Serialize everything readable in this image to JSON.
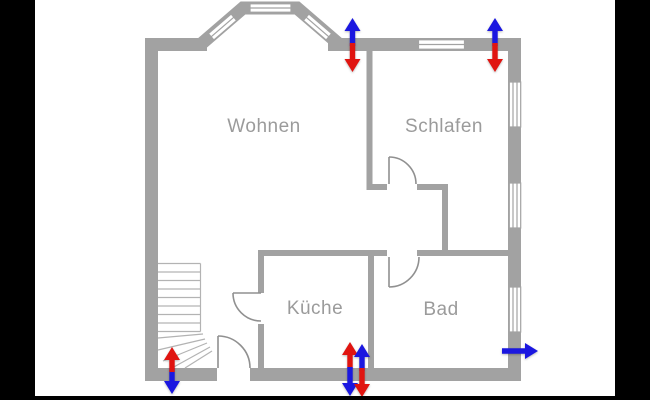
{
  "scene": {
    "type": "floor-plan",
    "description": "Apartment floor plan with red/blue ventilation airflow arrows"
  },
  "rooms": {
    "wohnen": {
      "label": "Wohnen"
    },
    "schlafen": {
      "label": "Schlafen"
    },
    "kueche": {
      "label": "Küche"
    },
    "bad": {
      "label": "Bad"
    }
  },
  "arrows": [
    {
      "id": "top-wohnen",
      "position": "top wall right of bay window",
      "blue": "up",
      "red": "down"
    },
    {
      "id": "top-schlafen",
      "position": "top wall right of window",
      "blue": "up",
      "red": "down"
    },
    {
      "id": "bottom-stairs",
      "position": "bottom wall at staircase",
      "red": "up",
      "blue": "down"
    },
    {
      "id": "bottom-kueche-left",
      "position": "bottom wall at kitchen",
      "red": "up",
      "blue": "down"
    },
    {
      "id": "bottom-kueche-right",
      "position": "bottom wall at kitchen",
      "blue": "up",
      "red": "down"
    },
    {
      "id": "bad-right",
      "position": "right wall at bathroom",
      "blue": "right"
    }
  ],
  "colors": {
    "background": "#ffffff",
    "letterbox": "#000000",
    "wall": "#a2a2a2",
    "door": "#909090",
    "stairs": "#b3b3b3",
    "label": "#9b9b9b",
    "supply": "#e01410",
    "exhaust": "#1b17e0"
  }
}
